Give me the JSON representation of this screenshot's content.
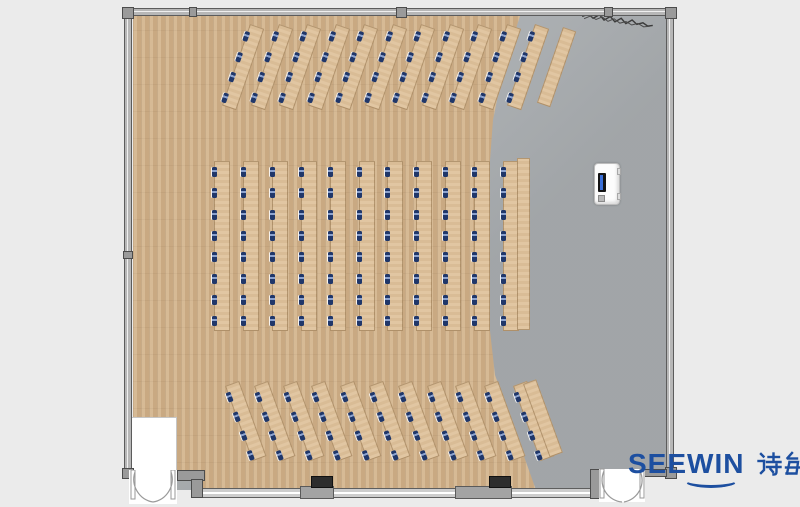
{
  "meta": {
    "description": "Top-down floor plan rendering of a classroom / training room",
    "watermark": "SEEWIN 诗敏"
  },
  "logo": {
    "brand": "SEEWIN",
    "cn": "诗敏",
    "color": "#1d4fa0"
  },
  "palette": {
    "page_bg": "#ebebeb",
    "wood_floor": "#d2b38c",
    "stage_floor": "#a8acaf",
    "desk": "#dfc29c",
    "chair_blue": "#20376a",
    "wall": "#b7b7b7",
    "logo_blue": "#1d4fa0"
  },
  "plan": {
    "total_desk_rows": 33,
    "total_side_tables": 3,
    "total_seats": 176,
    "sections": [
      {
        "id": "front-angled-rows",
        "rows": 11,
        "seats_per_row": 4,
        "angle": 19,
        "origin_x": 250,
        "origin_y": 24,
        "dx": 28.5,
        "strip_w": 15,
        "strip_h": 86,
        "chair_start": 7,
        "chair_gap": 21.5,
        "side_table": {
          "x": 563,
          "y": 27,
          "w": 14,
          "h": 80
        }
      },
      {
        "id": "middle-straight-rows",
        "rows": 11,
        "seats_per_row": 8,
        "angle": 0,
        "origin_x": 214,
        "origin_y": 161,
        "dx": 28.9,
        "strip_w": 16,
        "strip_h": 170,
        "chair_start": 5,
        "chair_gap": 21.3,
        "side_table": {
          "x": 517,
          "y": 158,
          "w": 13,
          "h": 172
        }
      },
      {
        "id": "back-angled-rows",
        "rows": 11,
        "seats_per_row": 4,
        "angle": -20,
        "origin_x": 225,
        "origin_y": 386,
        "dx": 28.8,
        "strip_w": 15,
        "strip_h": 80,
        "chair_start": 6,
        "chair_gap": 20.5,
        "side_table": {
          "x": 523,
          "y": 384,
          "w": 14,
          "h": 78
        }
      }
    ],
    "lectern": {
      "present": true
    },
    "doors": [
      {
        "id": "entry-door-bottom-left",
        "type": "double-swing"
      },
      {
        "id": "entry-door-bottom-right",
        "type": "double-swing"
      }
    ],
    "wall_columns": 2
  }
}
